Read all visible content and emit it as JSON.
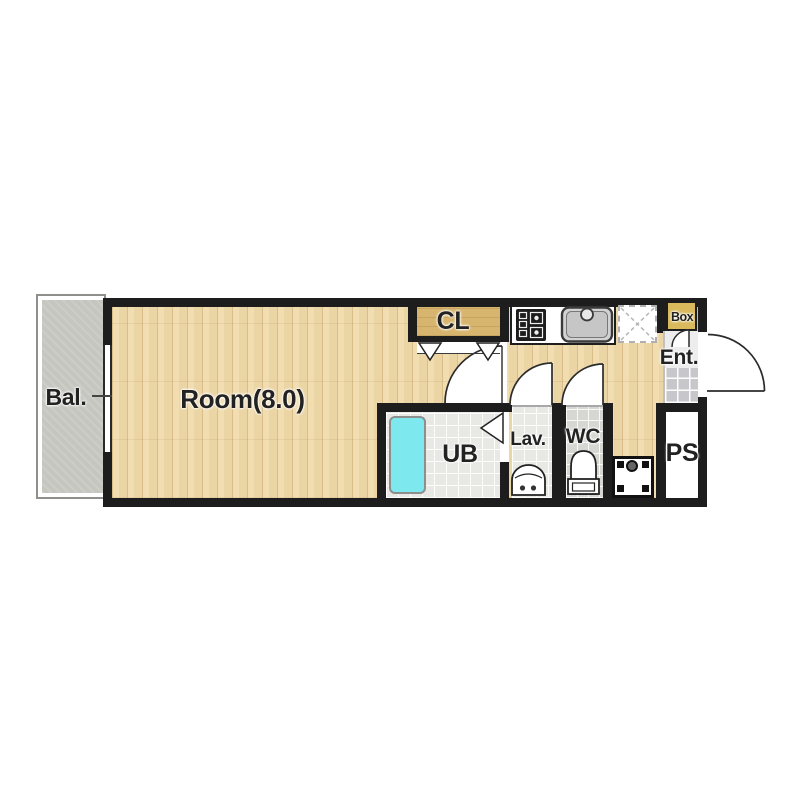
{
  "floorplan": {
    "rooms": {
      "balcony": {
        "label": "Bal."
      },
      "main_room": {
        "label": "Room(8.0)"
      },
      "closet": {
        "label": "CL"
      },
      "unit_bath": {
        "label": "UB"
      },
      "lavatory": {
        "label": "Lav."
      },
      "toilet": {
        "label": "WC"
      },
      "entrance": {
        "label": "Ent."
      },
      "pipe_space": {
        "label": "PS"
      },
      "shoe_box": {
        "label": "Box"
      }
    },
    "colors": {
      "wall": "#1d1d1d",
      "wood": "#f0d9a8",
      "closet": "#d8b56e",
      "box": "#d9b95c",
      "balcony": "#c6c6c1",
      "bathtub": "#7de9ee",
      "wet_floor": "#e8e8e4",
      "wc_floor": "#d6d6d2",
      "tile_floor": "#c7c7cb",
      "line": "#2b2b2b"
    },
    "fixtures": [
      "stove-icon",
      "kitchen-sink-icon",
      "refrigerator-space-icon",
      "bathtub-icon",
      "washbasin-icon",
      "toilet-icon",
      "washing-machine-pan-icon",
      "window-icon",
      "entrance-door-arc-icon",
      "room-door-arc-icon",
      "lavatory-door-arc-icon",
      "toilet-door-arc-icon",
      "shoe-box-door-arc-icon",
      "closet-bifold-door-icon",
      "bath-folding-door-icon"
    ]
  }
}
